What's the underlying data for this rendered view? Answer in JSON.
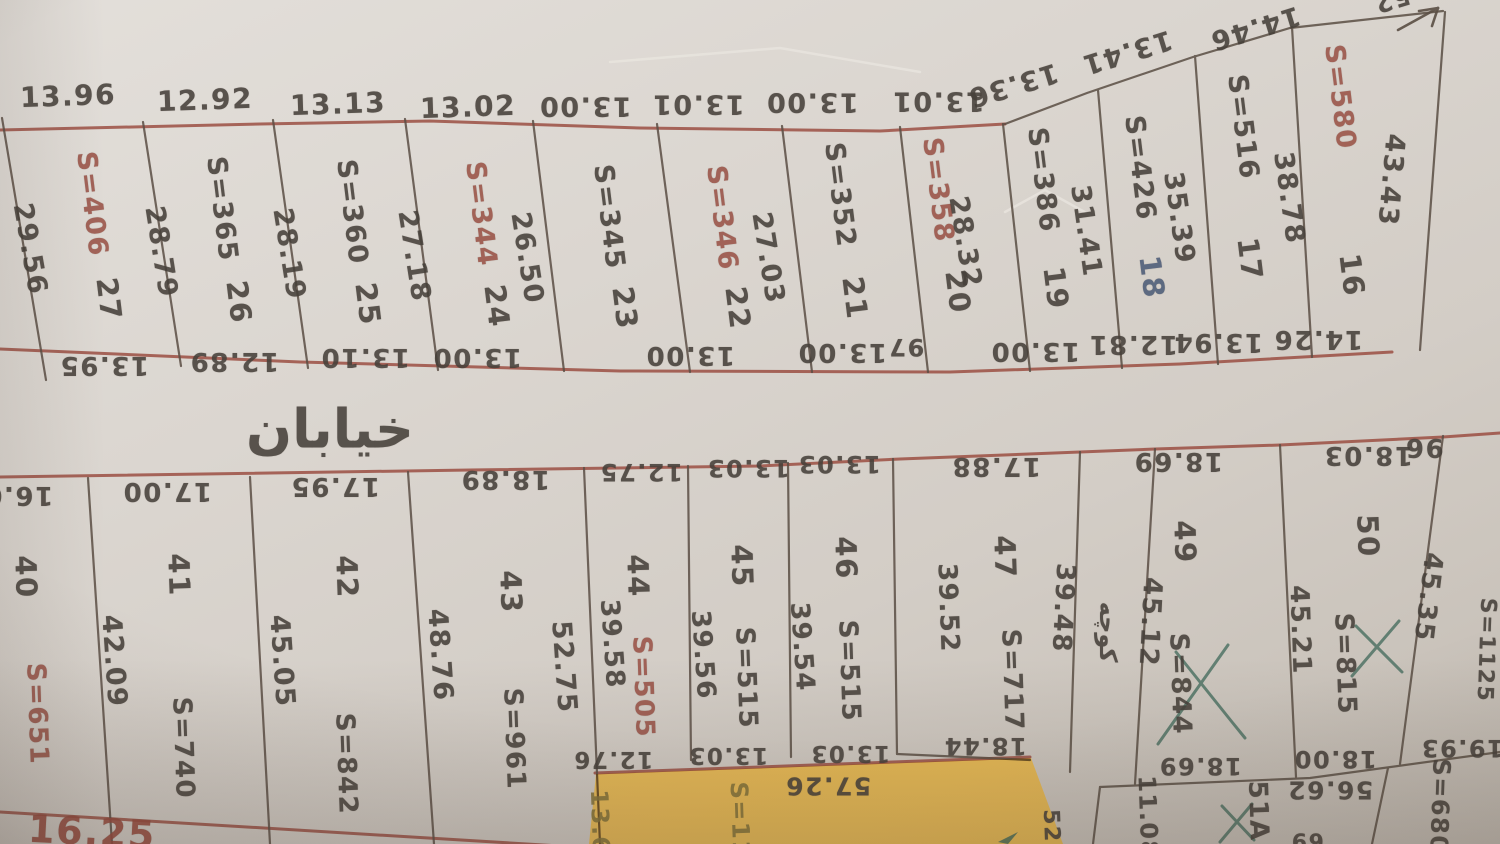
{
  "meta": {
    "description": "Photograph of a hand-drawn cadastral subdivision plan with two rows of numbered land plots, Persian street labels, plot areas (S=) and edge dimensions in metres",
    "street_label": "خیابان",
    "alley_label": "کوچه"
  },
  "colors": {
    "paper": "#d8d3cd",
    "line_dark": "#5a4e44",
    "line_red": "#99493d",
    "text_dark": "#46403a",
    "text_red": "#9a5347",
    "text_blue": "#4d5c78",
    "text_olive": "#85743a",
    "pen_green": "#3f685a",
    "highlight_yellow": "#eeb637"
  },
  "labels": {
    "top_block_top_widths": [
      {
        "n": "top-width-plot-27",
        "t": "13.96",
        "x": 68,
        "y": 96,
        "r": -2,
        "s": 28
      },
      {
        "n": "top-width-plot-26",
        "t": "12.92",
        "x": 205,
        "y": 100,
        "r": -2,
        "s": 28
      },
      {
        "n": "top-width-plot-25",
        "t": "13.13",
        "x": 338,
        "y": 104,
        "r": -2,
        "s": 28
      },
      {
        "n": "top-width-plot-24",
        "t": "13.02",
        "x": 468,
        "y": 107,
        "r": -2,
        "s": 28
      },
      {
        "n": "top-width-plot-23",
        "t": "13.00",
        "x": 585,
        "y": 106,
        "r": 180,
        "s": 27
      },
      {
        "n": "top-width-plot-22",
        "t": "13.01",
        "x": 698,
        "y": 104,
        "r": 180,
        "s": 27
      },
      {
        "n": "top-width-plot-21",
        "t": "13.00",
        "x": 812,
        "y": 102,
        "r": 180,
        "s": 27
      },
      {
        "n": "top-width-plot-20",
        "t": "13.01",
        "x": 938,
        "y": 101,
        "r": 180,
        "s": 27
      },
      {
        "n": "top-width-plot-19",
        "t": "13.36",
        "x": 1013,
        "y": 85,
        "r": 163,
        "s": 27
      },
      {
        "n": "top-width-plot-18",
        "t": "13.41",
        "x": 1127,
        "y": 52,
        "r": 163,
        "s": 27
      },
      {
        "n": "top-width-plot-17",
        "t": "14.46",
        "x": 1255,
        "y": 28,
        "r": 163,
        "s": 27
      },
      {
        "n": "top-width-fragment",
        "t": "52",
        "x": 1392,
        "y": 0,
        "r": 163,
        "s": 24
      }
    ],
    "top_block_areas": [
      {
        "n": "plot-27-area",
        "t": "S=406",
        "x": 92,
        "y": 204,
        "r": 83,
        "c": "red",
        "s": 27
      },
      {
        "n": "plot-26-area",
        "t": "S=365",
        "x": 222,
        "y": 209,
        "r": 83,
        "s": 27
      },
      {
        "n": "plot-25-area",
        "t": "S=360",
        "x": 352,
        "y": 212,
        "r": 83,
        "s": 27
      },
      {
        "n": "plot-24-area",
        "t": "S=344",
        "x": 481,
        "y": 214,
        "r": 83,
        "c": "red",
        "s": 27
      },
      {
        "n": "plot-23-area",
        "t": "S=345",
        "x": 609,
        "y": 217,
        "r": 83,
        "s": 27
      },
      {
        "n": "plot-22-area",
        "t": "S=346",
        "x": 722,
        "y": 218,
        "r": 83,
        "c": "red",
        "s": 27
      },
      {
        "n": "plot-21-area",
        "t": "S=352",
        "x": 840,
        "y": 195,
        "r": 83,
        "s": 27
      },
      {
        "n": "plot-20-area",
        "t": "S=358",
        "x": 938,
        "y": 190,
        "r": 83,
        "c": "red",
        "s": 27
      },
      {
        "n": "plot-19-area",
        "t": "S=386",
        "x": 1043,
        "y": 180,
        "r": 83,
        "s": 27
      },
      {
        "n": "plot-18-area",
        "t": "S=426",
        "x": 1140,
        "y": 168,
        "r": 83,
        "s": 27
      },
      {
        "n": "plot-17-area",
        "t": "S=516",
        "x": 1243,
        "y": 127,
        "r": 83,
        "s": 27
      },
      {
        "n": "plot-16-area",
        "t": "S=580",
        "x": 1340,
        "y": 97,
        "r": 83,
        "c": "red",
        "s": 27
      }
    ],
    "top_block_numbers": [
      {
        "n": "plot-27-number",
        "t": "27",
        "x": 109,
        "y": 299,
        "r": 83,
        "s": 29
      },
      {
        "n": "plot-26-number",
        "t": "26",
        "x": 239,
        "y": 302,
        "r": 83,
        "s": 29
      },
      {
        "n": "plot-25-number",
        "t": "25",
        "x": 368,
        "y": 304,
        "r": 83,
        "s": 29
      },
      {
        "n": "plot-24-number",
        "t": "24",
        "x": 497,
        "y": 306,
        "r": 83,
        "s": 29
      },
      {
        "n": "plot-23-number",
        "t": "23",
        "x": 625,
        "y": 308,
        "r": 83,
        "s": 29
      },
      {
        "n": "plot-22-number",
        "t": "22",
        "x": 738,
        "y": 308,
        "r": 83,
        "s": 29
      },
      {
        "n": "plot-21-number",
        "t": "21",
        "x": 855,
        "y": 298,
        "r": 83,
        "s": 29
      },
      {
        "n": "plot-20-number",
        "t": "20",
        "x": 958,
        "y": 292,
        "r": 83,
        "s": 29
      },
      {
        "n": "plot-19-number",
        "t": "19",
        "x": 1056,
        "y": 288,
        "r": 83,
        "s": 29
      },
      {
        "n": "plot-18-number",
        "t": "18",
        "x": 1152,
        "y": 277,
        "r": 83,
        "c": "blue",
        "s": 29
      },
      {
        "n": "plot-17-number",
        "t": "17",
        "x": 1250,
        "y": 259,
        "r": 83,
        "s": 29
      },
      {
        "n": "plot-16-number",
        "t": "16",
        "x": 1352,
        "y": 275,
        "r": 83,
        "s": 29
      }
    ],
    "top_block_side_lengths": [
      {
        "n": "side-left-of-27",
        "t": "29.56",
        "x": 30,
        "y": 249,
        "r": 80,
        "s": 27
      },
      {
        "n": "side-27-26",
        "t": "28.79",
        "x": 161,
        "y": 252,
        "r": 81,
        "s": 27
      },
      {
        "n": "side-26-25",
        "t": "28.19",
        "x": 289,
        "y": 254,
        "r": 81,
        "s": 27
      },
      {
        "n": "side-25-24",
        "t": "27.18",
        "x": 414,
        "y": 256,
        "r": 81,
        "s": 27
      },
      {
        "n": "side-24-23",
        "t": "26.50",
        "x": 527,
        "y": 258,
        "r": 81,
        "s": 27
      },
      {
        "n": "side-22-21",
        "t": "27.03",
        "x": 768,
        "y": 258,
        "r": 81,
        "s": 27
      },
      {
        "n": "side-20-19",
        "t": "28.32",
        "x": 965,
        "y": 242,
        "r": 81,
        "s": 27
      },
      {
        "n": "side-19-18",
        "t": "31.41",
        "x": 1086,
        "y": 231,
        "r": 82,
        "s": 27
      },
      {
        "n": "side-18-17",
        "t": "35.39",
        "x": 1179,
        "y": 218,
        "r": 82,
        "s": 27
      },
      {
        "n": "side-17-16",
        "t": "38.78",
        "x": 1289,
        "y": 198,
        "r": 82,
        "s": 27
      },
      {
        "n": "side-right-of-16",
        "t": "43.43",
        "x": 1391,
        "y": 180,
        "r": 95,
        "s": 27
      }
    ],
    "top_block_bottom_widths": [
      {
        "n": "bottom-width-plot-27",
        "t": "13.95",
        "x": 104,
        "y": 365,
        "r": 180,
        "s": 26
      },
      {
        "n": "bottom-width-plot-26",
        "t": "12.89",
        "x": 234,
        "y": 361,
        "r": 180,
        "s": 26
      },
      {
        "n": "bottom-width-plot-25",
        "t": "13.10",
        "x": 365,
        "y": 357,
        "r": 180,
        "s": 26
      },
      {
        "n": "bottom-width-plot-24",
        "t": "13.00",
        "x": 477,
        "y": 357,
        "r": 180,
        "s": 26
      },
      {
        "n": "bottom-width-plot-23",
        "t": "13.00",
        "x": 690,
        "y": 355,
        "r": 180,
        "s": 26
      },
      {
        "n": "bottom-width-plot-21",
        "t": "13.00",
        "x": 842,
        "y": 352,
        "r": 180,
        "s": 26
      },
      {
        "n": "bottom-width-fragment",
        "t": "97",
        "x": 906,
        "y": 347,
        "r": 180,
        "s": 24
      },
      {
        "n": "bottom-width-plot-19",
        "t": "13.00",
        "x": 1035,
        "y": 351,
        "r": 180,
        "s": 26
      },
      {
        "n": "bottom-width-plot-18",
        "t": "12.81",
        "x": 1133,
        "y": 344,
        "r": 180,
        "s": 26
      },
      {
        "n": "bottom-width-plot-17",
        "t": "13.94",
        "x": 1218,
        "y": 342,
        "r": 180,
        "s": 26
      },
      {
        "n": "bottom-width-plot-16",
        "t": "14.26",
        "x": 1318,
        "y": 339,
        "r": 180,
        "s": 26
      }
    ],
    "street": [
      {
        "n": "street-name-label",
        "t": "خیابان",
        "x": 330,
        "y": 429,
        "r": 0,
        "s": 54
      },
      {
        "n": "alley-name-label",
        "t": "کوچه",
        "x": 1108,
        "y": 632,
        "r": 90,
        "s": 24
      }
    ],
    "bottom_block_top_widths": [
      {
        "n": "top-width-plot-40",
        "t": "16.0",
        "x": 18,
        "y": 495,
        "r": 180,
        "s": 26
      },
      {
        "n": "top-width-plot-41",
        "t": "17.00",
        "x": 167,
        "y": 491,
        "r": 180,
        "s": 26
      },
      {
        "n": "top-width-plot-42",
        "t": "17.95",
        "x": 335,
        "y": 486,
        "r": 180,
        "s": 26
      },
      {
        "n": "top-width-plot-43",
        "t": "18.89",
        "x": 505,
        "y": 479,
        "r": 180,
        "s": 26
      },
      {
        "n": "top-width-plot-44",
        "t": "12.75",
        "x": 641,
        "y": 472,
        "r": 180,
        "s": 24
      },
      {
        "n": "top-width-plot-45",
        "t": "13.03",
        "x": 748,
        "y": 468,
        "r": 180,
        "s": 24
      },
      {
        "n": "top-width-plot-46",
        "t": "13.03",
        "x": 839,
        "y": 464,
        "r": 180,
        "s": 24
      },
      {
        "n": "top-width-plot-47",
        "t": "17.88",
        "x": 996,
        "y": 466,
        "r": 180,
        "s": 26
      },
      {
        "n": "top-width-plot-49",
        "t": "18.69",
        "x": 1178,
        "y": 461,
        "r": 180,
        "s": 26
      },
      {
        "n": "top-width-plot-50",
        "t": "18.03",
        "x": 1368,
        "y": 455,
        "r": 180,
        "s": 26
      },
      {
        "n": "top-width-right-fragment",
        "t": "96",
        "x": 1424,
        "y": 447,
        "r": 180,
        "s": 26
      }
    ],
    "bottom_block_areas": [
      {
        "n": "plot-40-area",
        "t": "S=651",
        "x": 37,
        "y": 714,
        "r": 88,
        "c": "red",
        "s": 26
      },
      {
        "n": "plot-41-area",
        "t": "S=740",
        "x": 183,
        "y": 748,
        "r": 88,
        "s": 26
      },
      {
        "n": "plot-42-area",
        "t": "S=842",
        "x": 346,
        "y": 764,
        "r": 88,
        "s": 26
      },
      {
        "n": "plot-43-area",
        "t": "S=961",
        "x": 514,
        "y": 739,
        "r": 88,
        "s": 26
      },
      {
        "n": "plot-44-area",
        "t": "S=505",
        "x": 643,
        "y": 687,
        "r": 88,
        "c": "red",
        "s": 26
      },
      {
        "n": "plot-45-area",
        "t": "S=515",
        "x": 746,
        "y": 678,
        "r": 88,
        "s": 26
      },
      {
        "n": "plot-46-area",
        "t": "S=515",
        "x": 849,
        "y": 671,
        "r": 88,
        "s": 26
      },
      {
        "n": "plot-47-area",
        "t": "S=717",
        "x": 1012,
        "y": 680,
        "r": 88,
        "s": 26
      },
      {
        "n": "plot-49-area",
        "t": "S=844",
        "x": 1180,
        "y": 684,
        "r": 88,
        "s": 26
      },
      {
        "n": "plot-50-area",
        "t": "S=815",
        "x": 1345,
        "y": 664,
        "r": 88,
        "s": 26
      },
      {
        "n": "plot-right-area",
        "t": "S=1125",
        "x": 1486,
        "y": 650,
        "r": 92,
        "s": 22
      }
    ],
    "bottom_block_numbers": [
      {
        "n": "plot-40-number",
        "t": "40",
        "x": 26,
        "y": 577,
        "r": 88,
        "s": 29
      },
      {
        "n": "plot-41-number",
        "t": "41",
        "x": 179,
        "y": 575,
        "r": 88,
        "s": 29
      },
      {
        "n": "plot-42-number",
        "t": "42",
        "x": 347,
        "y": 577,
        "r": 88,
        "s": 29
      },
      {
        "n": "plot-43-number",
        "t": "43",
        "x": 511,
        "y": 592,
        "r": 88,
        "s": 29
      },
      {
        "n": "plot-44-number",
        "t": "44",
        "x": 638,
        "y": 576,
        "r": 88,
        "s": 29
      },
      {
        "n": "plot-45-number",
        "t": "45",
        "x": 742,
        "y": 566,
        "r": 88,
        "s": 29
      },
      {
        "n": "plot-46-number",
        "t": "46",
        "x": 846,
        "y": 558,
        "r": 88,
        "s": 29
      },
      {
        "n": "plot-47-number",
        "t": "47",
        "x": 1005,
        "y": 557,
        "r": 88,
        "s": 29
      },
      {
        "n": "plot-49-number",
        "t": "49",
        "x": 1185,
        "y": 542,
        "r": 88,
        "s": 29
      },
      {
        "n": "plot-50-number",
        "t": "50",
        "x": 1368,
        "y": 536,
        "r": 88,
        "s": 29
      },
      {
        "n": "plot-51A-number",
        "t": "51A",
        "x": 1258,
        "y": 811,
        "r": 88,
        "s": 26
      },
      {
        "n": "plot-680-area-fragment",
        "t": "S=680",
        "x": 1440,
        "y": 806,
        "r": 92,
        "s": 24
      }
    ],
    "bottom_block_side_lengths": [
      {
        "n": "side-40-41",
        "t": "42.09",
        "x": 114,
        "y": 661,
        "r": 86,
        "s": 27
      },
      {
        "n": "side-41-42",
        "t": "45.05",
        "x": 282,
        "y": 661,
        "r": 86,
        "s": 27
      },
      {
        "n": "side-42-43",
        "t": "48.76",
        "x": 440,
        "y": 655,
        "r": 86,
        "s": 27
      },
      {
        "n": "side-43-44-left",
        "t": "52.75",
        "x": 564,
        "y": 667,
        "r": 86,
        "s": 27
      },
      {
        "n": "side-43-44-right",
        "t": "39.58",
        "x": 612,
        "y": 644,
        "r": 86,
        "s": 26
      },
      {
        "n": "side-44-45",
        "t": "39.56",
        "x": 703,
        "y": 655,
        "r": 86,
        "s": 26
      },
      {
        "n": "side-45-46",
        "t": "39.54",
        "x": 802,
        "y": 647,
        "r": 86,
        "s": 26
      },
      {
        "n": "side-46-47",
        "t": "39.52",
        "x": 948,
        "y": 608,
        "r": 88,
        "s": 26
      },
      {
        "n": "side-47-alley",
        "t": "39.48",
        "x": 1063,
        "y": 608,
        "r": 93,
        "s": 26
      },
      {
        "n": "side-alley-49",
        "t": "45.12",
        "x": 1150,
        "y": 622,
        "r": 93,
        "s": 26
      },
      {
        "n": "side-49-50",
        "t": "45.21",
        "x": 1300,
        "y": 630,
        "r": 88,
        "s": 26
      },
      {
        "n": "side-50-right",
        "t": "45.35",
        "x": 1428,
        "y": 597,
        "r": 97,
        "s": 26
      }
    ],
    "bottom_block_bottom_labels": [
      {
        "n": "bottom-width-plot-44",
        "t": "12.76",
        "x": 613,
        "y": 759,
        "r": 180,
        "s": 23
      },
      {
        "n": "bottom-width-plot-45",
        "t": "13.03",
        "x": 728,
        "y": 755,
        "r": 180,
        "s": 23
      },
      {
        "n": "bottom-width-plot-46",
        "t": "13.03",
        "x": 850,
        "y": 753,
        "r": 180,
        "s": 23
      },
      {
        "n": "bottom-width-plot-47",
        "t": "18.44",
        "x": 985,
        "y": 746,
        "r": 180,
        "s": 24
      },
      {
        "n": "bottom-width-plot-49",
        "t": "18.69",
        "x": 1200,
        "y": 766,
        "r": 180,
        "s": 24
      },
      {
        "n": "bottom-width-plot-50",
        "t": "18.00",
        "x": 1335,
        "y": 759,
        "r": 180,
        "s": 24
      },
      {
        "n": "bottom-width-plot-right",
        "t": "19.93",
        "x": 1462,
        "y": 748,
        "r": 180,
        "s": 24
      },
      {
        "n": "length-51A-top",
        "t": "56.62",
        "x": 1330,
        "y": 790,
        "r": 180,
        "s": 25
      },
      {
        "n": "length-highlight-top",
        "t": "57.26",
        "x": 828,
        "y": 786,
        "r": 180,
        "s": 25
      },
      {
        "n": "side-51A-left",
        "t": "11.08",
        "x": 1148,
        "y": 817,
        "r": 88,
        "s": 24
      },
      {
        "n": "bottom-fragment-69",
        "t": "69",
        "x": 1307,
        "y": 840,
        "r": 180,
        "s": 22
      }
    ],
    "highlight_plot": [
      {
        "n": "highlight-plot-left-side-fragment",
        "t": "13.6",
        "x": 600,
        "y": 822,
        "r": 88,
        "c": "olive",
        "s": 24
      },
      {
        "n": "highlight-plot-area-fragment",
        "t": "S=11",
        "x": 740,
        "y": 820,
        "r": 88,
        "c": "olive",
        "s": 24
      },
      {
        "n": "highlight-plot-right-fragment",
        "t": "52",
        "x": 1051,
        "y": 826,
        "r": 88,
        "s": 22
      }
    ],
    "bottom_street": [
      {
        "n": "bottom-street-length",
        "t": "16.25",
        "x": 92,
        "y": 832,
        "r": 3,
        "c": "redline",
        "s": 38
      }
    ]
  }
}
